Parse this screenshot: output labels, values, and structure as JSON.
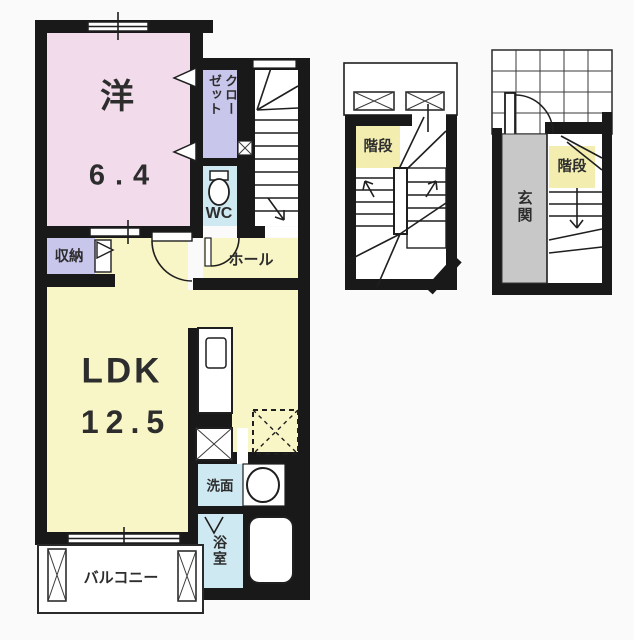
{
  "rooms": {
    "western": {
      "name": "洋",
      "area": "6.4"
    },
    "closet": {
      "label": "クローゼット",
      "line1": "クロー",
      "line2": "ゼット"
    },
    "wc": {
      "label": "WC"
    },
    "storage": {
      "label": "収納"
    },
    "hall": {
      "label": "ホール"
    },
    "ldk": {
      "name": "LDK",
      "area": "12.5"
    },
    "washroom": {
      "label": "洗面"
    },
    "bathroom": {
      "label": "浴室"
    },
    "balcony": {
      "label": "バルコニー"
    }
  },
  "sections": {
    "middle": {
      "stairs_label": "階段"
    },
    "right": {
      "entrance_label": "玄関",
      "stairs_label": "階段"
    }
  },
  "colors": {
    "wall": "#191919",
    "western_room": "#f2dcec",
    "closet": "#c9c6ec",
    "storage": "#c9c6ec",
    "wc": "#cfe9f2",
    "washroom": "#cfe9f2",
    "bathroom": "#cfe9f2",
    "ldk": "#f8f5c6",
    "hall": "#f8f5c6",
    "stairs_label": "#f3eeb0",
    "entrance": "#c8c8c8",
    "background": "#fafafa",
    "white": "#ffffff"
  }
}
